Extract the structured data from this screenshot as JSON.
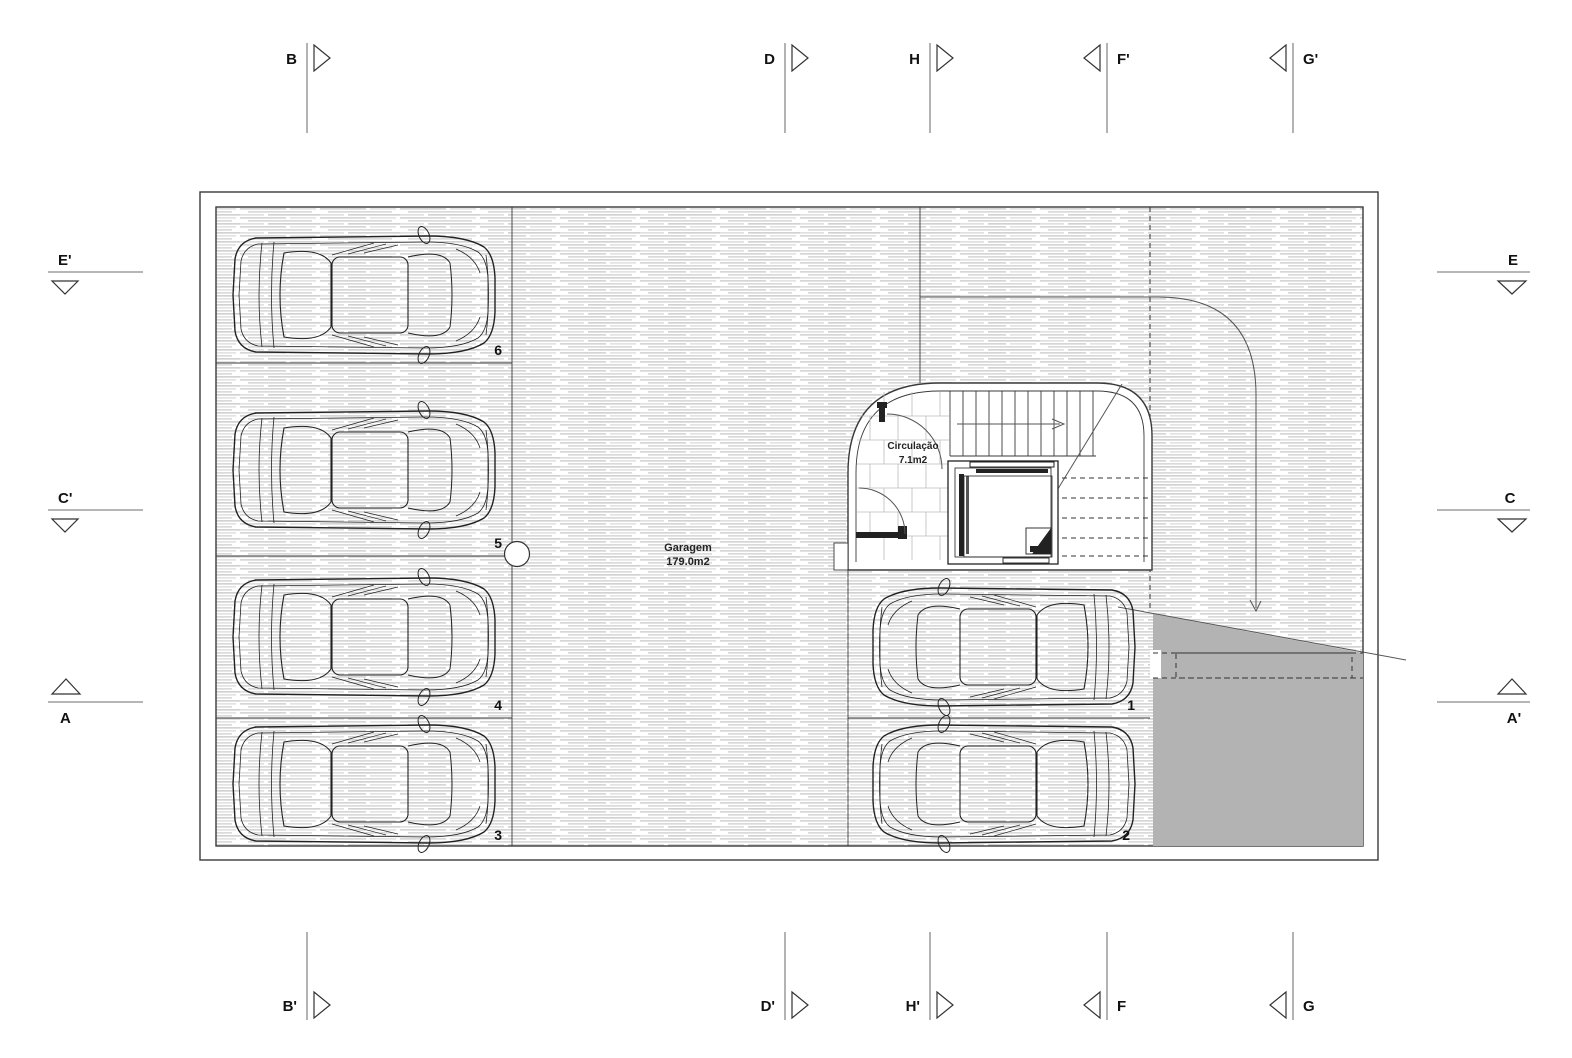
{
  "drawing": {
    "rooms": {
      "garage": {
        "name": "Garagem",
        "area": "179.0m2"
      },
      "circulation": {
        "name": "Circulação",
        "area": "7.1m2"
      }
    },
    "parking": {
      "spots": [
        {
          "number": "6"
        },
        {
          "number": "5"
        },
        {
          "number": "4"
        },
        {
          "number": "3"
        },
        {
          "number": "1"
        },
        {
          "number": "2"
        }
      ]
    },
    "markers": {
      "top": [
        {
          "label": "B"
        },
        {
          "label": "D"
        },
        {
          "label": "H"
        },
        {
          "label": "F'"
        },
        {
          "label": "G'"
        }
      ],
      "bottom": [
        {
          "label": "B'"
        },
        {
          "label": "D'"
        },
        {
          "label": "H'"
        },
        {
          "label": "F"
        },
        {
          "label": "G"
        }
      ],
      "left": [
        {
          "label": "E'"
        },
        {
          "label": "C'"
        },
        {
          "label": "A"
        }
      ],
      "right": [
        {
          "label": "E"
        },
        {
          "label": "C"
        },
        {
          "label": "A'"
        }
      ]
    },
    "colors": {
      "ramp": "#b3b3b3",
      "wall": "#3a3a3a",
      "section_line": "#8a8a8a"
    }
  }
}
